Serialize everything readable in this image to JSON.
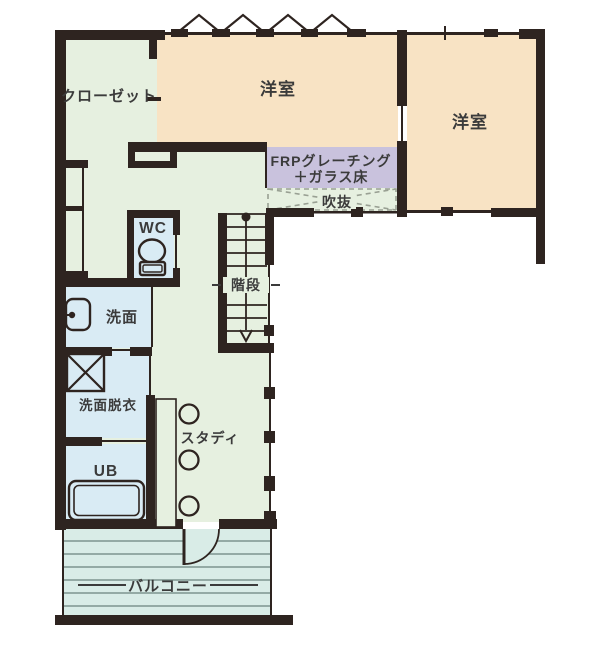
{
  "rooms": {
    "closet": {
      "label": "クローゼット"
    },
    "bedroom_top": {
      "label": "洋室"
    },
    "bedroom_right": {
      "label": "洋室"
    },
    "frp_walkway": {
      "label_line1": "FRPグレーチング",
      "label_line2": "＋ガラス床"
    },
    "void": {
      "label": "吹抜"
    },
    "wc": {
      "label": "WC"
    },
    "washroom": {
      "label": "洗面"
    },
    "stairs": {
      "label": "階段"
    },
    "dressing": {
      "label": "洗面脱衣"
    },
    "bath": {
      "label": "UB"
    },
    "study": {
      "label": "スタディ"
    },
    "balcony": {
      "label": "バルコニー"
    }
  },
  "colors": {
    "bedroom_fill": "#f8e3c4",
    "hall_fill": "#e6f0e0",
    "wet_fill": "#d9ebf4",
    "frp_fill": "#c9c2dd",
    "balcony_fill": "#d9ece7",
    "balcony_stripe": "#7e948f",
    "wall": "#2e2420",
    "text": "#3b3b3b",
    "void_dash": "#99a093"
  }
}
